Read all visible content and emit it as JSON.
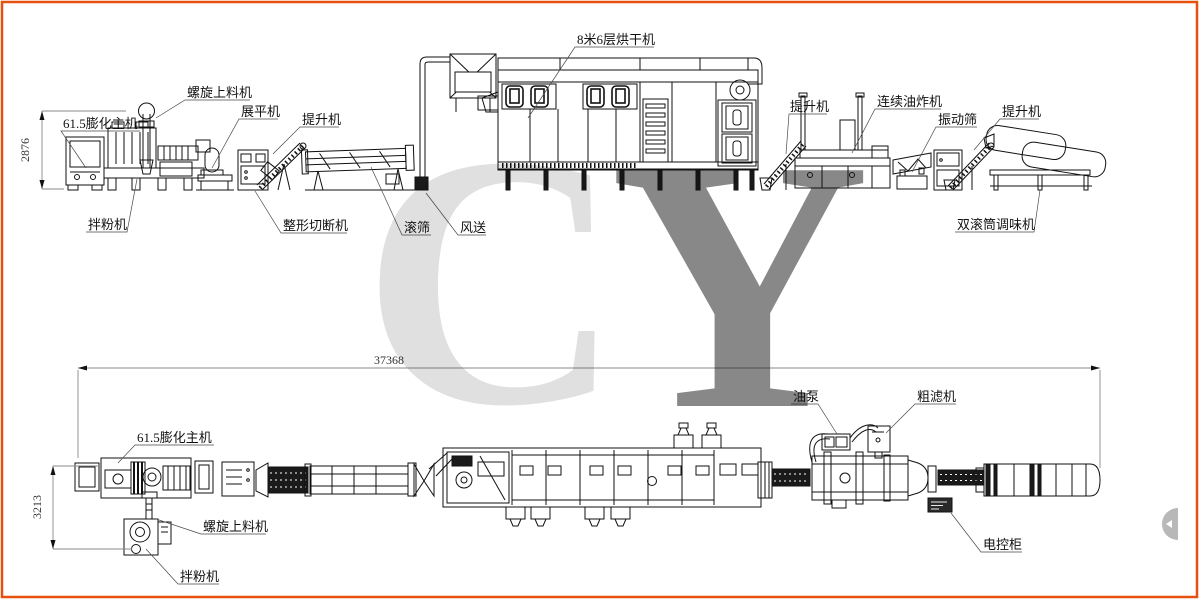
{
  "watermark": {
    "c": "C",
    "y": "Y",
    "color": "#e0301e"
  },
  "border_color": "#e8500f",
  "top_view": {
    "labels": {
      "screw_feeder": "螺旋上料机",
      "extruder": "61.5膨化主机",
      "flattener": "展平机",
      "elevator_1": "提升机",
      "mixer": "拌粉机",
      "shaping_cutter": "整形切断机",
      "roller_screen": "滚筛",
      "air_conveyor": "风送",
      "dryer": "8米6层烘干机",
      "elevator_2": "提升机",
      "fryer": "连续油炸机",
      "vibrating_screen": "振动筛",
      "elevator_3": "提升机",
      "seasoning_machine": "双滚筒调味机"
    },
    "height_dim": "2876"
  },
  "plan_view": {
    "labels": {
      "extruder": "61.5膨化主机",
      "screw_feeder": "螺旋上料机",
      "mixer": "拌粉机",
      "oil_pump": "油泵",
      "coarse_filter": "粗滤机",
      "control_cabinet": "电控柜"
    },
    "length_dim": "37368",
    "width_dim": "3213"
  }
}
